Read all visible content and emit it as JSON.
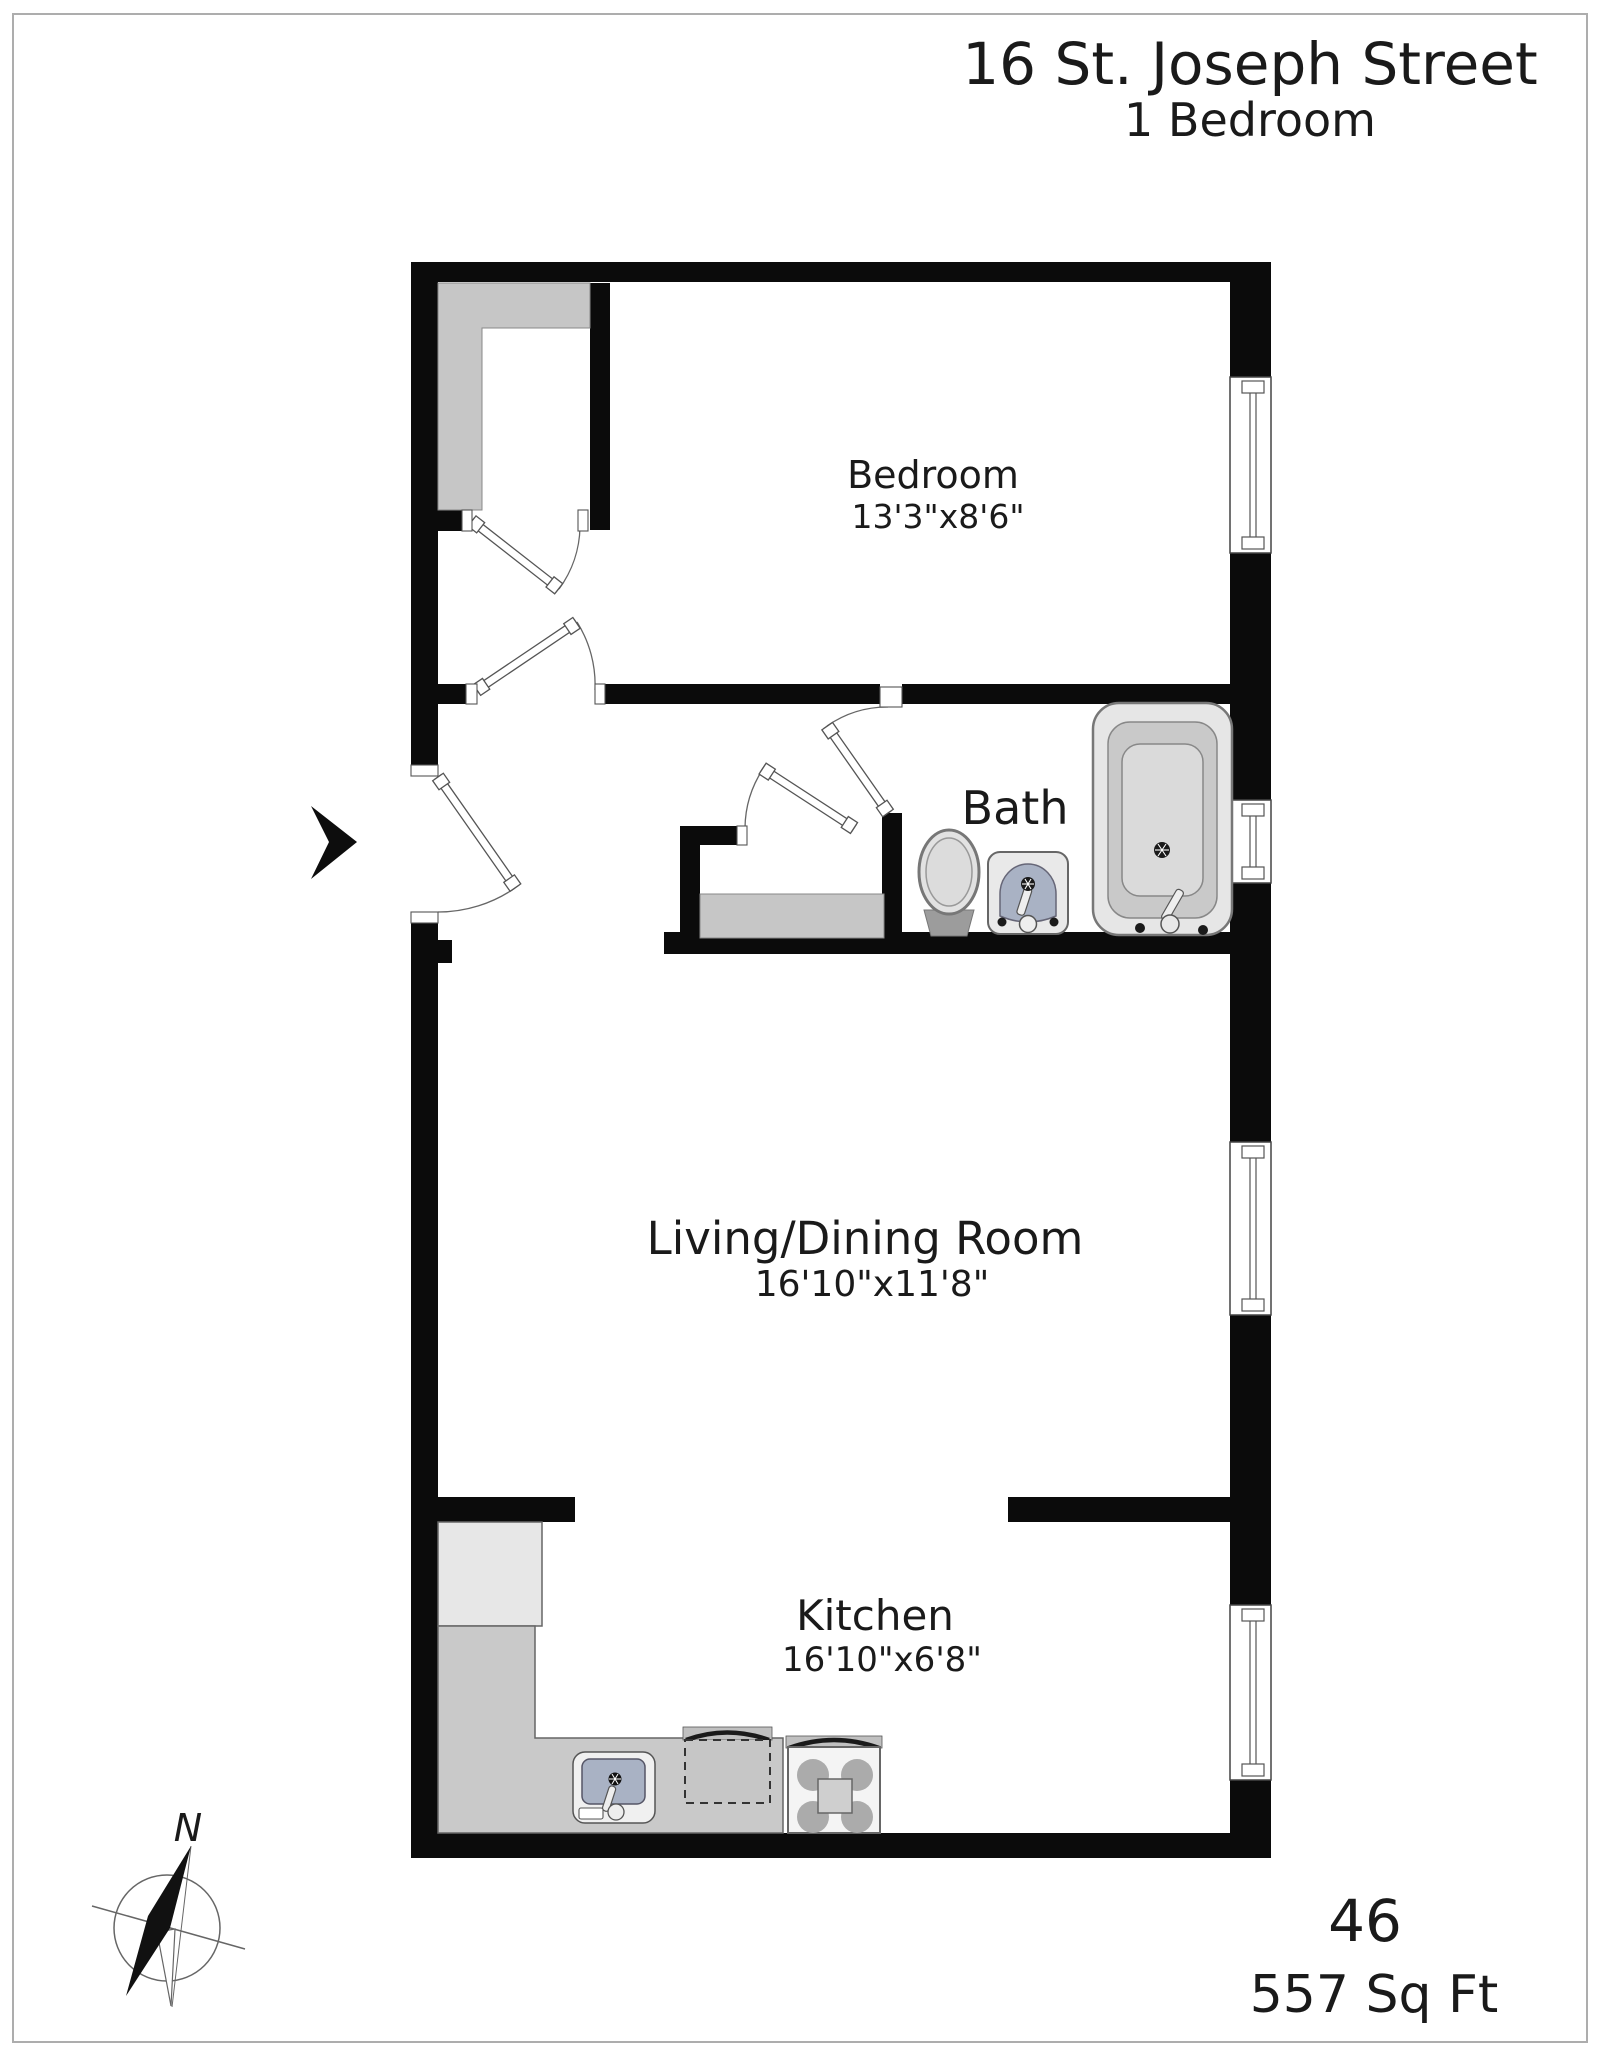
{
  "title": {
    "address": "16 St. Joseph Street",
    "subtitle": "1 Bedroom"
  },
  "rooms": {
    "bedroom": {
      "name": "Bedroom",
      "dims": "13'3\"x8'6\""
    },
    "bath": {
      "name": "Bath"
    },
    "living": {
      "name": "Living/Dining Room",
      "dims": "16'10\"x11'8\""
    },
    "kitchen": {
      "name": "Kitchen",
      "dims": "16'10\"x6'8\""
    }
  },
  "footer": {
    "unit_number": "46",
    "area": "557 Sq Ft"
  },
  "compass": {
    "north_label": "N"
  },
  "icons": [
    "entry-arrow-icon",
    "compass-rose-icon",
    "bathtub-icon",
    "toilet-icon",
    "bathroom-sink-icon",
    "kitchen-sink-icon",
    "stove-icon",
    "refrigerator-icon",
    "dishwasher-icon",
    "window-icon",
    "door-swing-icon"
  ],
  "colors": {
    "wall": "#0b0b0b",
    "shelf_gray": "#c6c6c6",
    "counter_gray": "#c9c9c9",
    "appliance_light": "#e7e7e7",
    "basin_blue": "#a9b2c4",
    "text": "#1a1a1a"
  }
}
